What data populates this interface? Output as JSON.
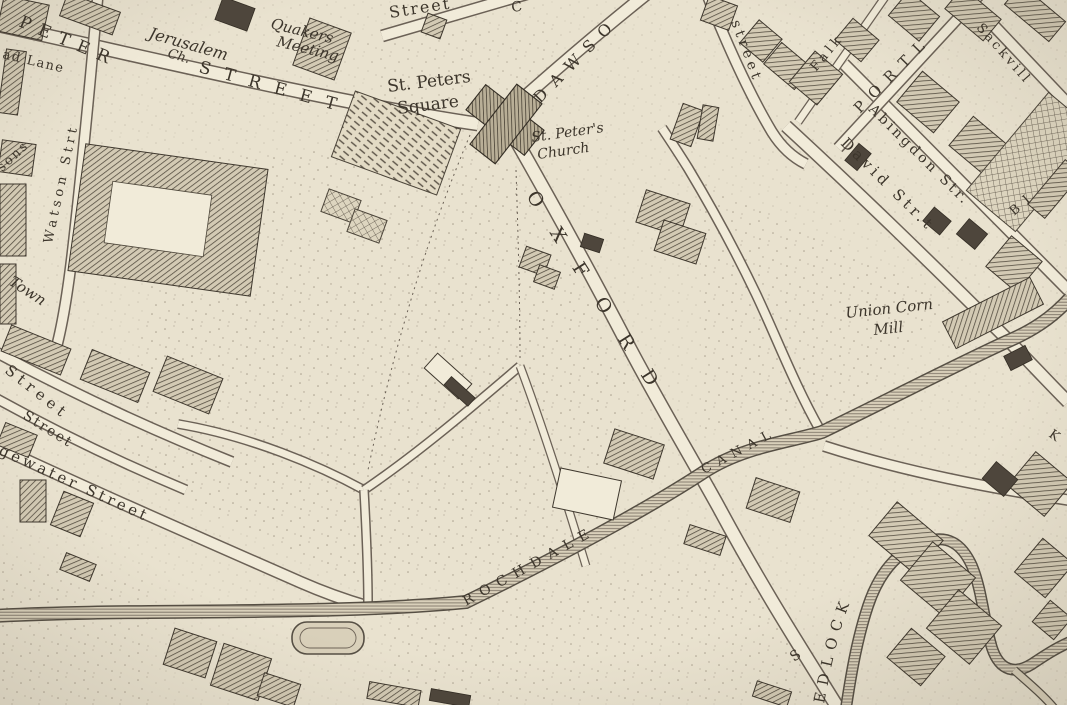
{
  "colors": {
    "paper": "#e9e2cf",
    "paper_light": "#f1ebd9",
    "ink": "#3c352b",
    "ink_soft": "#6b6156",
    "water": "#d9d0ba",
    "building": "#7a7163"
  },
  "labels": {
    "ad_lane": "ad Lane",
    "peter": "PETER",
    "street_peter": "STREET",
    "jerusalem": "Jerusalem",
    "jerusalem_ch": "Ch.",
    "quakers": "Quakers",
    "meeting": "Meeting",
    "street_top": "Street",
    "frag_c": "C",
    "st_peters": "St. Peters",
    "square": "Square",
    "dawson": "DAWSO",
    "church_line1": "St. Peter's",
    "church_line2": "Church",
    "street_frag_ne": "street",
    "falkner": "Falk",
    "portland": "PORTL",
    "sackville": "Sackvill",
    "abingdon": "Abingdon Str.",
    "david": "David Str.t",
    "frag_bi": "B I",
    "frag_k": "K",
    "oxford": "OXFORD",
    "union_corn": "Union Corn",
    "mill": "Mill",
    "canal": "CANAL",
    "rochdale": "ROCHDALE",
    "watson": "Watson Strt",
    "frag_sons": "sons",
    "town": "Town",
    "street_left_1": "Street",
    "street_left_2": "Street",
    "bridgewater": "gewater Street",
    "medlock": "EDLOCK",
    "frag_s": "S"
  }
}
